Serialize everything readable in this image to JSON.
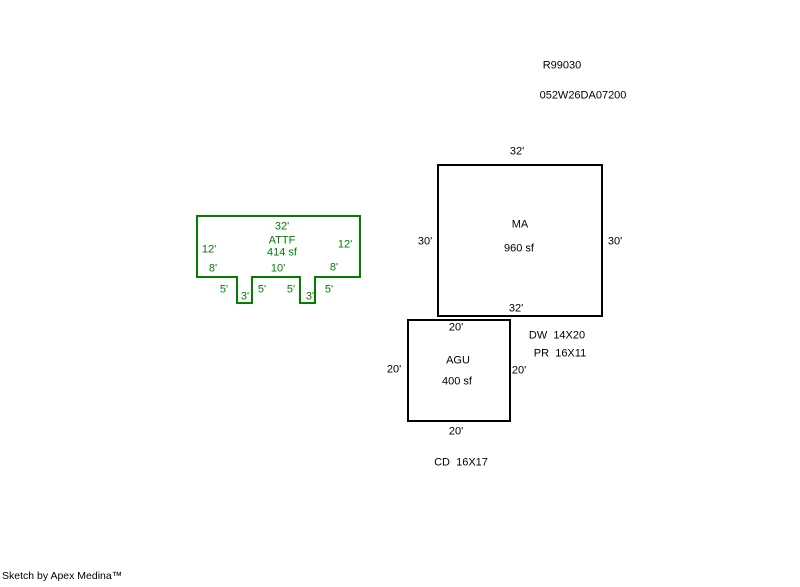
{
  "page": {
    "background": "#ffffff",
    "ink_color": "#000000",
    "accent_green": "#008000"
  },
  "header": {
    "sketch_id": "R99030",
    "parcel_id": "052W26DA07200"
  },
  "footer": {
    "credit": "Sketch by Apex Medina™"
  },
  "sketch": {
    "shapes": [
      {
        "name": "attf-outline",
        "type": "polygon",
        "color": "#008000",
        "stroke_width": 2,
        "points": [
          [
            197,
            216
          ],
          [
            360,
            216
          ],
          [
            360,
            277
          ],
          [
            315,
            277
          ],
          [
            315,
            303
          ],
          [
            300,
            303
          ],
          [
            300,
            277
          ],
          [
            252,
            277
          ],
          [
            252,
            303
          ],
          [
            237,
            303
          ],
          [
            237,
            277
          ],
          [
            197,
            277
          ]
        ]
      },
      {
        "name": "ma-outline",
        "type": "rect",
        "color": "#000000",
        "stroke_width": 2,
        "x": 438,
        "y": 165,
        "w": 164,
        "h": 151
      },
      {
        "name": "agu-outline",
        "type": "rect",
        "color": "#000000",
        "stroke_width": 2,
        "x": 408,
        "y": 320,
        "w": 102,
        "h": 101
      }
    ],
    "labels": [
      {
        "name": "sketch-id",
        "text": "R99030",
        "x": 562,
        "y": 66,
        "color": "#000000"
      },
      {
        "name": "parcel-id",
        "text": "052W26DA07200",
        "x": 583,
        "y": 96,
        "color": "#000000"
      },
      {
        "name": "attf-top-dim",
        "text": "32'",
        "x": 282,
        "y": 227,
        "color": "#008000"
      },
      {
        "name": "attf-label",
        "text": "ATTF",
        "x": 282,
        "y": 241,
        "color": "#008000"
      },
      {
        "name": "attf-area",
        "text": "414 sf",
        "x": 282,
        "y": 253,
        "color": "#008000"
      },
      {
        "name": "attf-left-dim",
        "text": "12'",
        "x": 209,
        "y": 250,
        "color": "#008000"
      },
      {
        "name": "attf-right-dim",
        "text": "12'",
        "x": 345,
        "y": 245,
        "color": "#008000"
      },
      {
        "name": "attf-bottom-left-dim",
        "text": "8'",
        "x": 213,
        "y": 269,
        "color": "#008000"
      },
      {
        "name": "attf-bottom-mid-dim",
        "text": "10'",
        "x": 278,
        "y": 269,
        "color": "#008000"
      },
      {
        "name": "attf-bottom-right-dim",
        "text": "8'",
        "x": 334,
        "y": 268,
        "color": "#008000"
      },
      {
        "name": "attf-tab1-left-dim",
        "text": "5'",
        "x": 224,
        "y": 290,
        "color": "#008000"
      },
      {
        "name": "attf-tab1-width-dim",
        "text": "3'",
        "x": 245,
        "y": 297,
        "color": "#008000"
      },
      {
        "name": "attf-tab1-right-dim",
        "text": "5'",
        "x": 262,
        "y": 290,
        "color": "#008000"
      },
      {
        "name": "attf-tab2-left-dim",
        "text": "5'",
        "x": 291,
        "y": 290,
        "color": "#008000"
      },
      {
        "name": "attf-tab2-width-dim",
        "text": "3'",
        "x": 310,
        "y": 297,
        "color": "#008000"
      },
      {
        "name": "attf-tab2-right-dim",
        "text": "5'",
        "x": 329,
        "y": 290,
        "color": "#008000"
      },
      {
        "name": "ma-top-dim",
        "text": "32'",
        "x": 517,
        "y": 152,
        "color": "#000000"
      },
      {
        "name": "ma-label",
        "text": "MA",
        "x": 520,
        "y": 225,
        "color": "#000000"
      },
      {
        "name": "ma-area",
        "text": "960 sf",
        "x": 519,
        "y": 249,
        "color": "#000000"
      },
      {
        "name": "ma-left-dim",
        "text": "30'",
        "x": 425,
        "y": 242,
        "color": "#000000"
      },
      {
        "name": "ma-right-dim",
        "text": "30'",
        "x": 615,
        "y": 242,
        "color": "#000000"
      },
      {
        "name": "ma-bottom-dim",
        "text": "32'",
        "x": 516,
        "y": 309,
        "color": "#000000"
      },
      {
        "name": "agu-top-dim",
        "text": "20'",
        "x": 456,
        "y": 328,
        "color": "#000000"
      },
      {
        "name": "agu-label",
        "text": "AGU",
        "x": 458,
        "y": 361,
        "color": "#000000"
      },
      {
        "name": "agu-area",
        "text": "400 sf",
        "x": 457,
        "y": 382,
        "color": "#000000"
      },
      {
        "name": "agu-left-dim",
        "text": "20'",
        "x": 394,
        "y": 370,
        "color": "#000000"
      },
      {
        "name": "agu-right-dim",
        "text": "20'",
        "x": 519,
        "y": 371,
        "color": "#000000"
      },
      {
        "name": "agu-bottom-dim",
        "text": "20'",
        "x": 456,
        "y": 432,
        "color": "#000000"
      },
      {
        "name": "dw-note",
        "text": "DW  14X20",
        "x": 557,
        "y": 336,
        "color": "#000000"
      },
      {
        "name": "pr-note",
        "text": "PR  16X11",
        "x": 560,
        "y": 354,
        "color": "#000000"
      },
      {
        "name": "cd-note",
        "text": "CD  16X17",
        "x": 461,
        "y": 463,
        "color": "#000000"
      }
    ]
  }
}
